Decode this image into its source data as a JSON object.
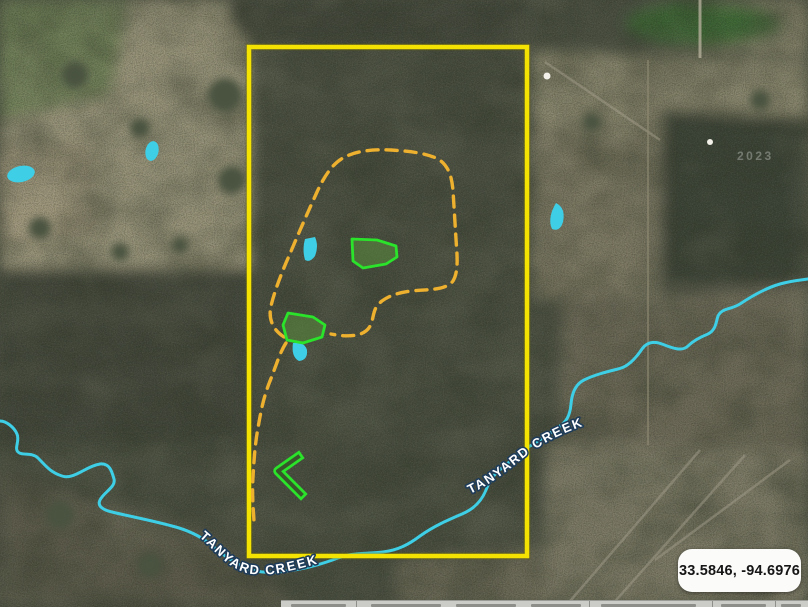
{
  "map": {
    "coordinate_readout": "33.5846, -94.6976",
    "imagery_watermark": "2023",
    "labels": {
      "creek_upper": "TANYARD CREEK",
      "creek_lower": "TANYARD CREEK"
    },
    "colors": {
      "property_boundary": "#f3e202",
      "trail": "#eeb02f",
      "plot_outline": "#2be32b",
      "water": "#3ecfe6",
      "label_text": "#ffffff",
      "label_outline": "#1e3c5a"
    }
  }
}
